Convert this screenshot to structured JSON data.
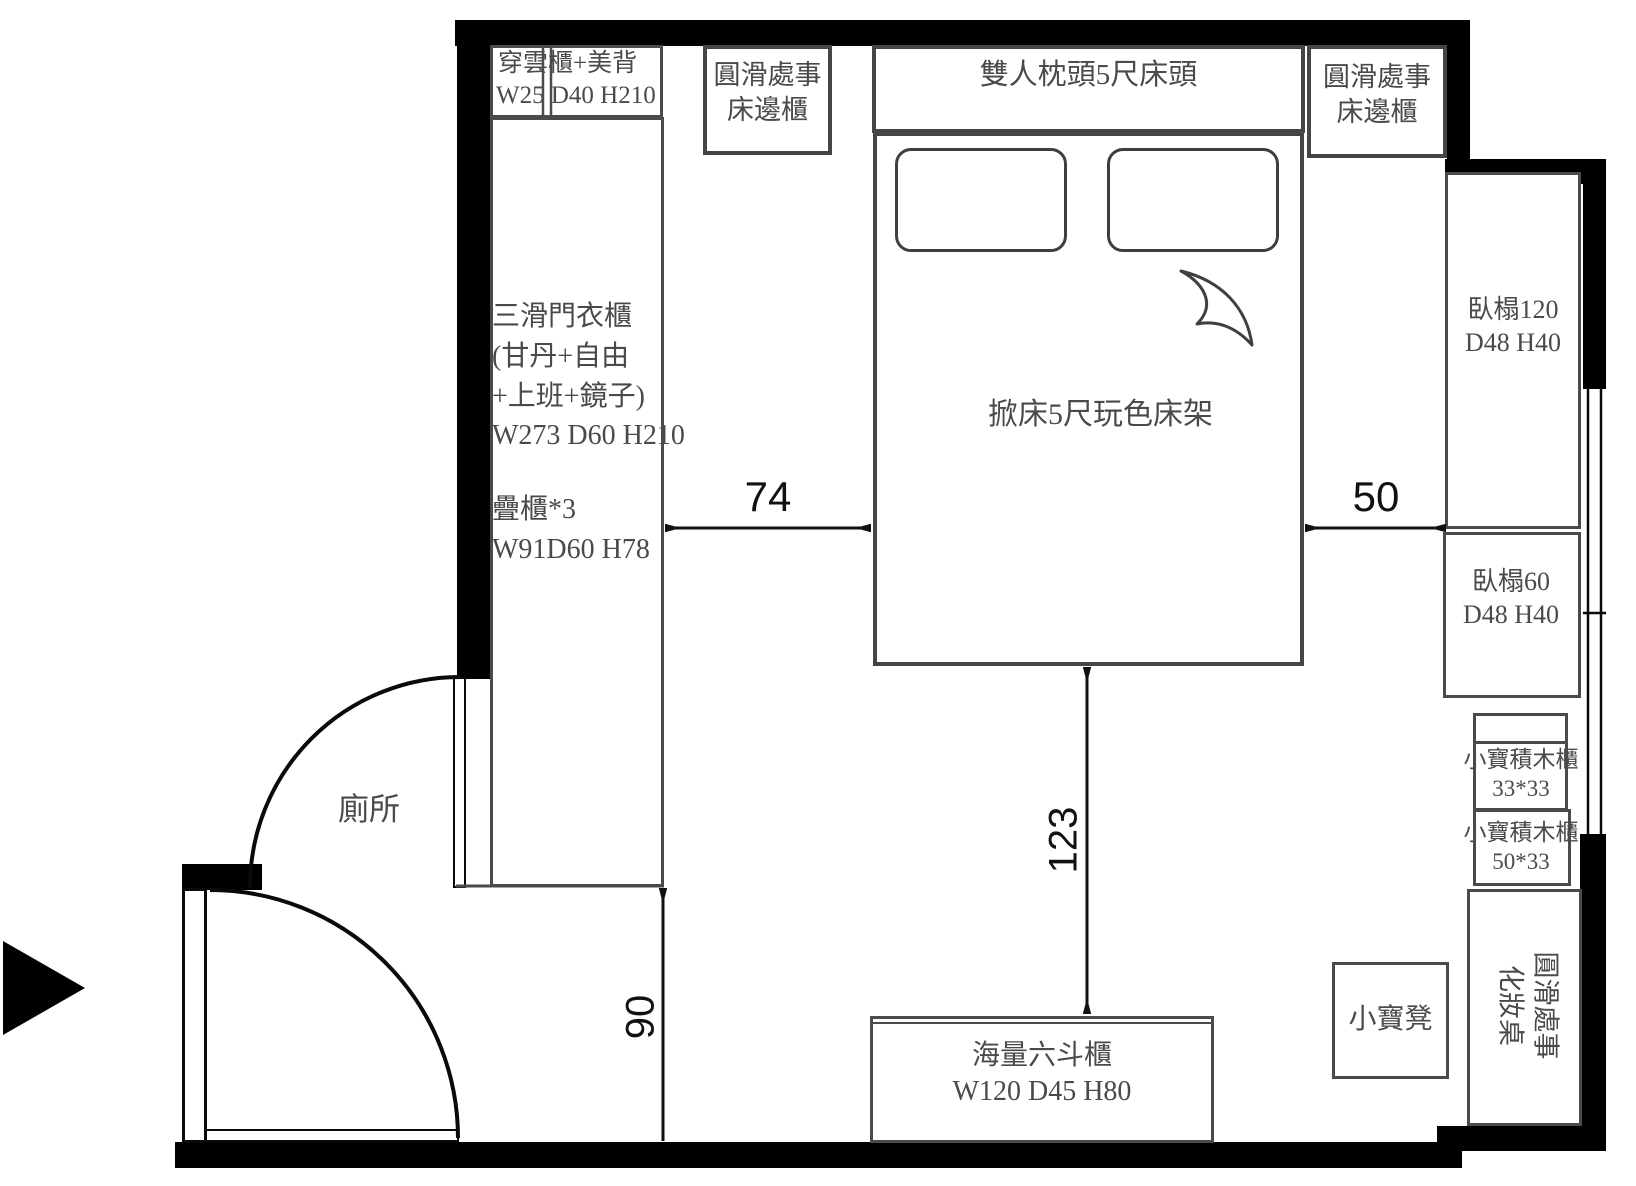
{
  "plan": {
    "toilet_label": "廁所",
    "cab_top_left": {
      "l1": "穿雲櫃+美背",
      "l2": "W25 D40 H210"
    },
    "bedside_left": {
      "l1": "圓滑處事",
      "l2": "床邊櫃"
    },
    "headboard": "雙人枕頭5尺床頭",
    "bedside_right": {
      "l1": "圓滑處事",
      "l2": "床邊櫃"
    },
    "wardrobe": {
      "l1": "三滑門衣櫃",
      "l2": "(甘丹+自由",
      "l3": "+上班+鏡子)",
      "l4": "W273 D60 H210",
      "l5": "疊櫃*3",
      "l6": "W91D60 H78"
    },
    "bed": "掀床5尺玩色床架",
    "bench120": {
      "l1": "臥榻120",
      "l2": "D48 H40"
    },
    "bench60": {
      "l1": "臥榻60",
      "l2": "D48 H40"
    },
    "blocks33": {
      "l1": "小寶積木櫃",
      "l2": "33*33"
    },
    "blocks50": {
      "l1": "小寶積木櫃",
      "l2": "50*33"
    },
    "stool": "小寶凳",
    "vanity": {
      "l1": "圓滑處事",
      "l2": "化妝桌"
    },
    "dresser": {
      "l1": "海量六斗櫃",
      "l2": "W120 D45 H80"
    },
    "dims": {
      "d74": "74",
      "d50": "50",
      "d123": "123",
      "d90": "90"
    },
    "colors": {
      "wall": "#000000",
      "line": "#4b4b4b",
      "text": "#4a4a4a",
      "dim_text": "#111111"
    }
  }
}
